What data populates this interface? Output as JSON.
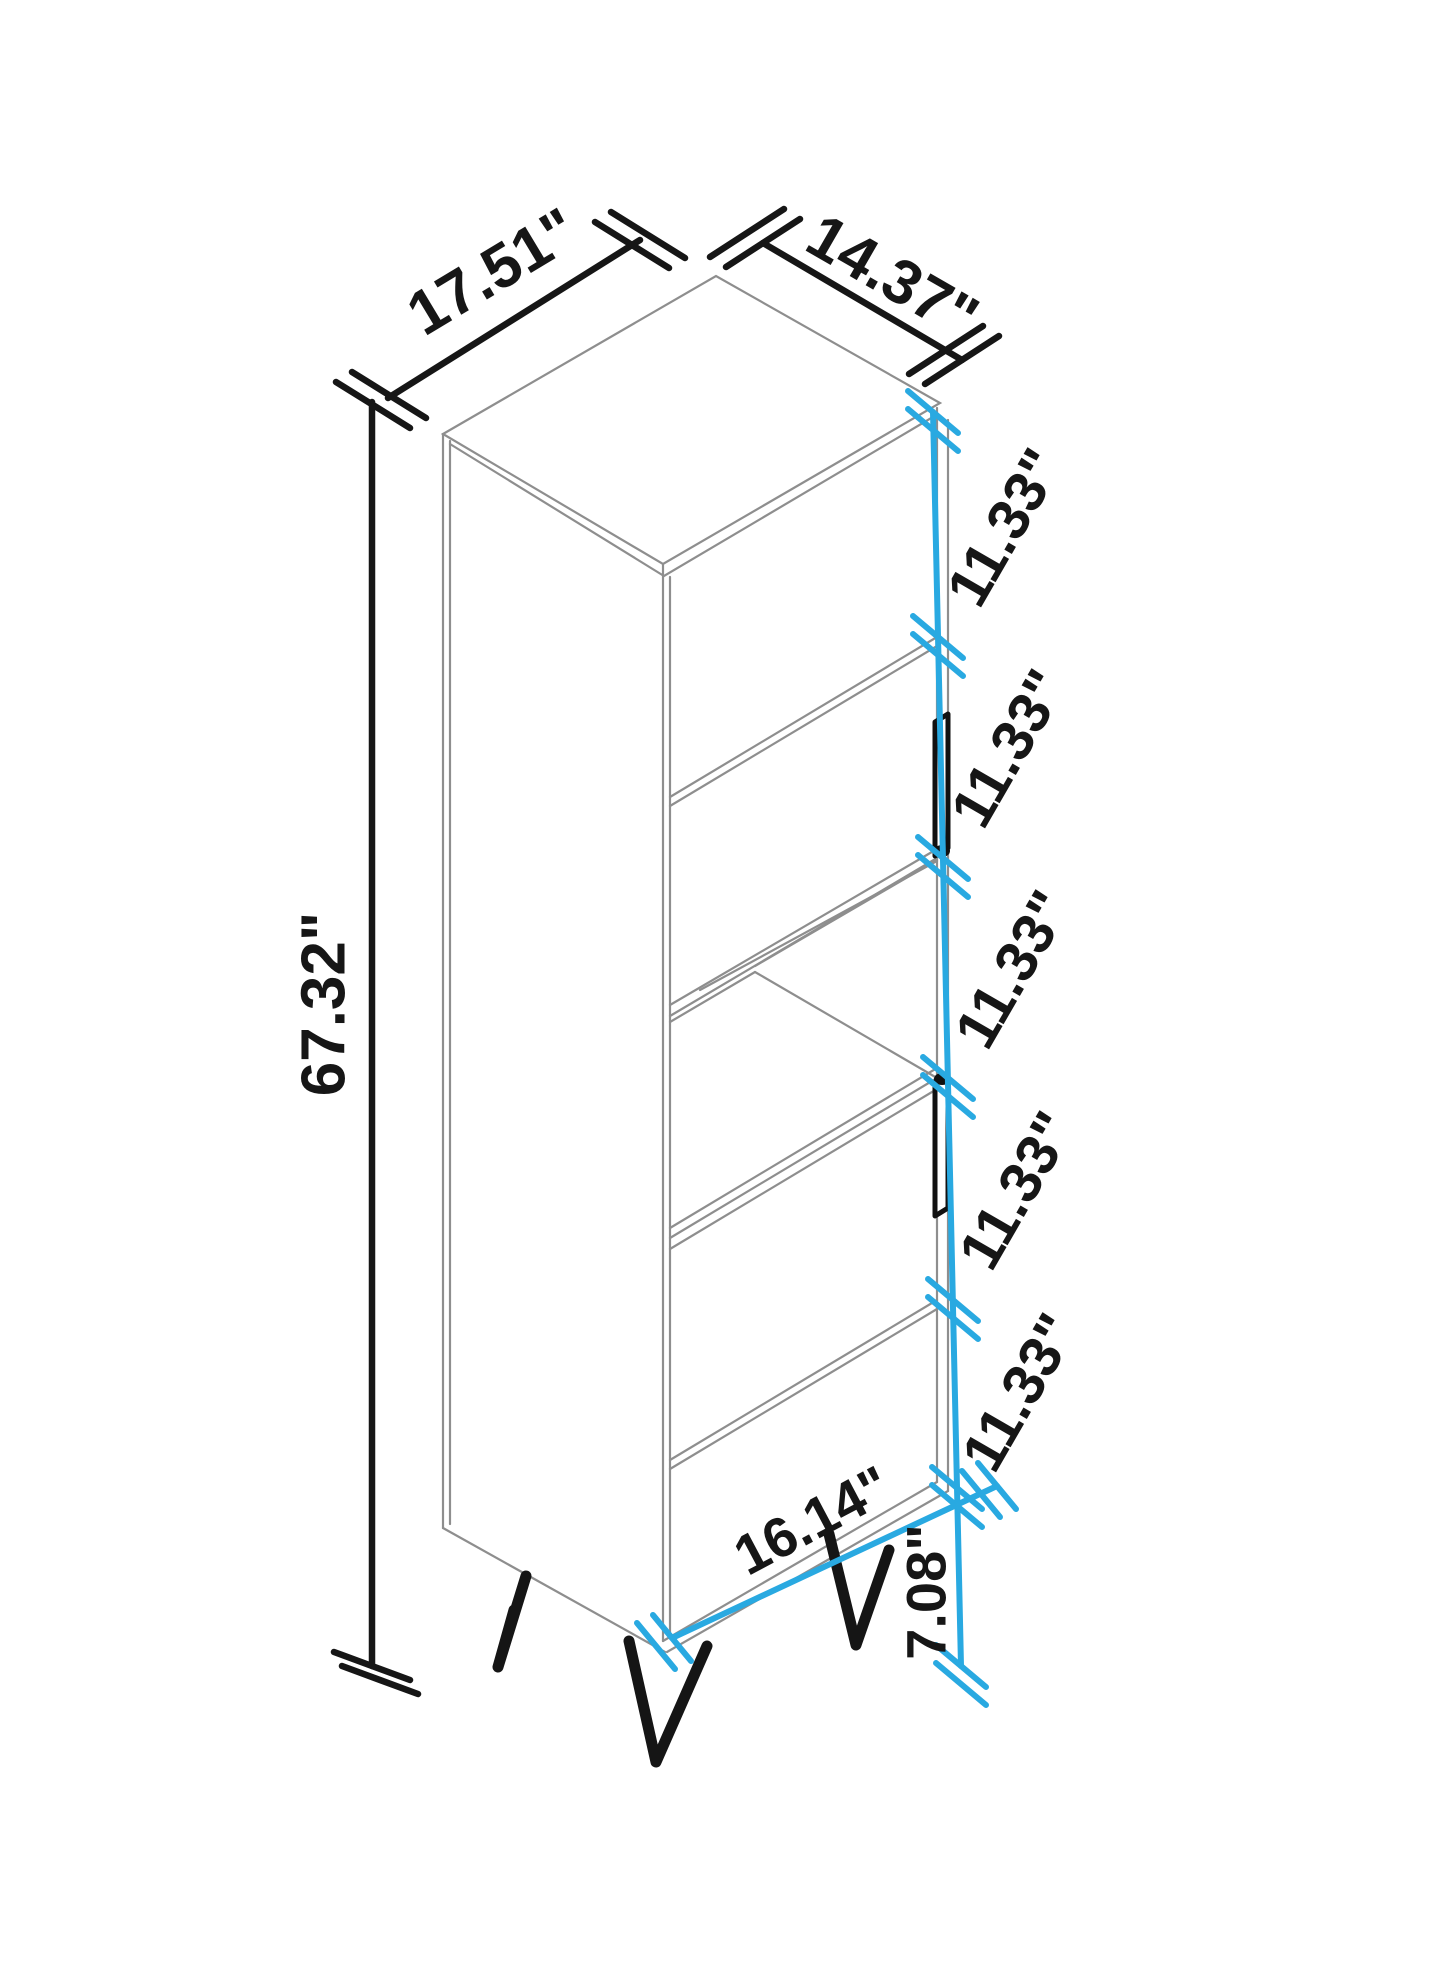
{
  "drawing": {
    "description": "Isometric technical dimension drawing of a tall 5-section bookcase cabinet with two doors and hairpin legs",
    "units": "inches",
    "colors": {
      "outline_gray": "#8e8e8e",
      "dimension_black": "#161616",
      "dimension_cyan": "#29a9e1",
      "background": "#ffffff",
      "handle_black": "#111111"
    },
    "labels": {
      "width": "17.51\"",
      "depth": "14.37\"",
      "height": "67.32\"",
      "sections": [
        "11.33\"",
        "11.33\"",
        "11.33\"",
        "11.33\"",
        "11.33\""
      ],
      "bottom_width": "16.14\"",
      "leg_height": "7.08\""
    }
  }
}
